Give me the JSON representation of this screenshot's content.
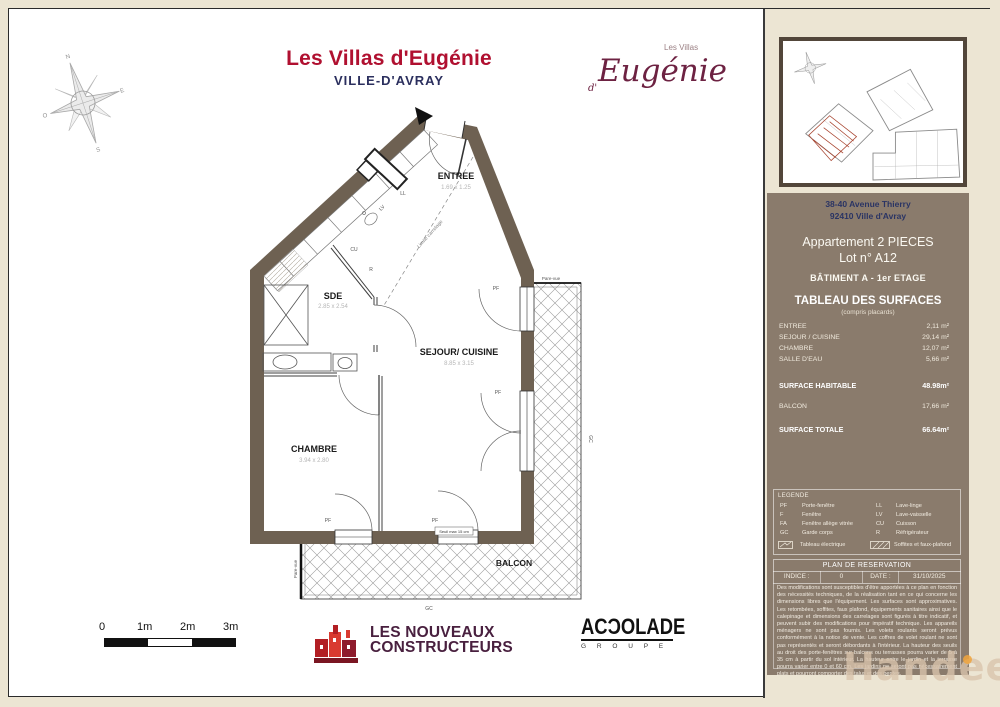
{
  "header": {
    "title": "Les Villas d'Eugénie",
    "subtitle": "VILLE-D'AVRAY"
  },
  "logo": {
    "top": "Les Villas",
    "d": "d'",
    "name": "Eugénie"
  },
  "compass": {
    "n": "N",
    "e": "E",
    "s": "S",
    "o": "O"
  },
  "plan": {
    "entree": {
      "name": "ENTREE",
      "dims": "1.69 x 1.25"
    },
    "sde": {
      "name": "SDE",
      "dims": "2.85 x 2.54"
    },
    "sejour": {
      "name": "SEJOUR/ CUISINE",
      "dims": "8.85 x 3.15"
    },
    "chambre": {
      "name": "CHAMBRE",
      "dims": "3.94 x 2.80"
    },
    "balcon": {
      "name": "BALCON"
    },
    "labels": {
      "pf": "PF",
      "gc": "GC",
      "ll": "LL",
      "lv": "LV",
      "cu": "CU",
      "r": "R",
      "pare_vue": "Pare-vue",
      "limite": "Limite carrelage",
      "seuil": "Seuil max 15 cm"
    }
  },
  "scale": {
    "t0": "0",
    "t1": "1m",
    "t2": "2m",
    "t3": "3m"
  },
  "footer": {
    "lnc1": "LES NOUVEAUX",
    "lnc2": "CONSTRUCTEURS",
    "accolade": "ACƆOLADE",
    "groupe": "G R O U P E"
  },
  "panel": {
    "address1": "38-40 Avenue Thierry",
    "address2": "92410 Ville d'Avray",
    "apt": "Appartement 2 PIECES",
    "lot": "Lot n° A12",
    "batiment": "BÂTIMENT A - 1er ETAGE",
    "table": {
      "title": "TABLEAU DES SURFACES",
      "subtitle": "(compris placards)",
      "rows": [
        [
          "ENTREE",
          "2,11 m²"
        ],
        [
          "SEJOUR / CUISINE",
          "29,14 m²"
        ],
        [
          "CHAMBRE",
          "12,07 m²"
        ],
        [
          "SALLE D'EAU",
          "5,66 m²"
        ]
      ],
      "habitable_label": "SURFACE HABITABLE",
      "habitable": "48.98m²",
      "balcon_label": "BALCON",
      "balcon": "17,66 m²",
      "totale_label": "SURFACE TOTALE",
      "totale": "66.64m²"
    },
    "legend": {
      "title": "LEGENDE",
      "rows_left": [
        [
          "PF",
          "Porte-fenêtre"
        ],
        [
          "F",
          "Fenêtre"
        ],
        [
          "FA",
          "Fenêtre allège vitrée"
        ],
        [
          "GC",
          "Garde corps"
        ]
      ],
      "rows_right": [
        [
          "LL",
          "Lave-linge"
        ],
        [
          "LV",
          "Lave-vaisselle"
        ],
        [
          "CU",
          "Cuisson"
        ],
        [
          "R",
          "Réfrigérateur"
        ]
      ],
      "electrique": "Tableau électrique",
      "soffites": "Soffites et faux-plafond"
    },
    "reservation": {
      "title": "PLAN DE RESERVATION",
      "indice_label": "INDICE :",
      "indice": "0",
      "date_label": "DATE :",
      "date": "31/10/2025",
      "disclaimer": "Des modifications sont susceptibles d'être apportées à ce plan en fonction des nécessités techniques, de la réalisation tant en ce qui concerne les dimensions libres que l'équipement. Les surfaces sont approximatives. Les retombées, soffites, faux plafond, équipements sanitaires ainsi que le calepinage et dimensions des carrelages sont figurés à titre indicatif, et peuvent subir des modifications pour impératif technique. Les appareils ménagers ne sont pas fournis. Les volets roulants seront prévus conformément à la notice de vente. Les coffres de volet roulant ne sont pas représentés et seront débordants à l'intérieur. La hauteur des seuils au droit des porte-fenêtres sur balcons ou terrasses pourra varier de 5 à 35 cm à partir du sol intérieur. La hauteur entre le jardin et la terrasse pourra varier entre 0 et 60 cm. Les jardins ne seront pas nécessairement plats et pourront comporter des talus et des pentes."
    }
  },
  "watermark": "Handeed",
  "colors": {
    "accent_red": "#b01030",
    "navy": "#2b2f5e",
    "maroon": "#6d2242",
    "panel_brown": "#8a7b6c",
    "wall_brown": "#6e6152",
    "lnc_text": "#49203f",
    "lot_red": "#a8442f"
  }
}
